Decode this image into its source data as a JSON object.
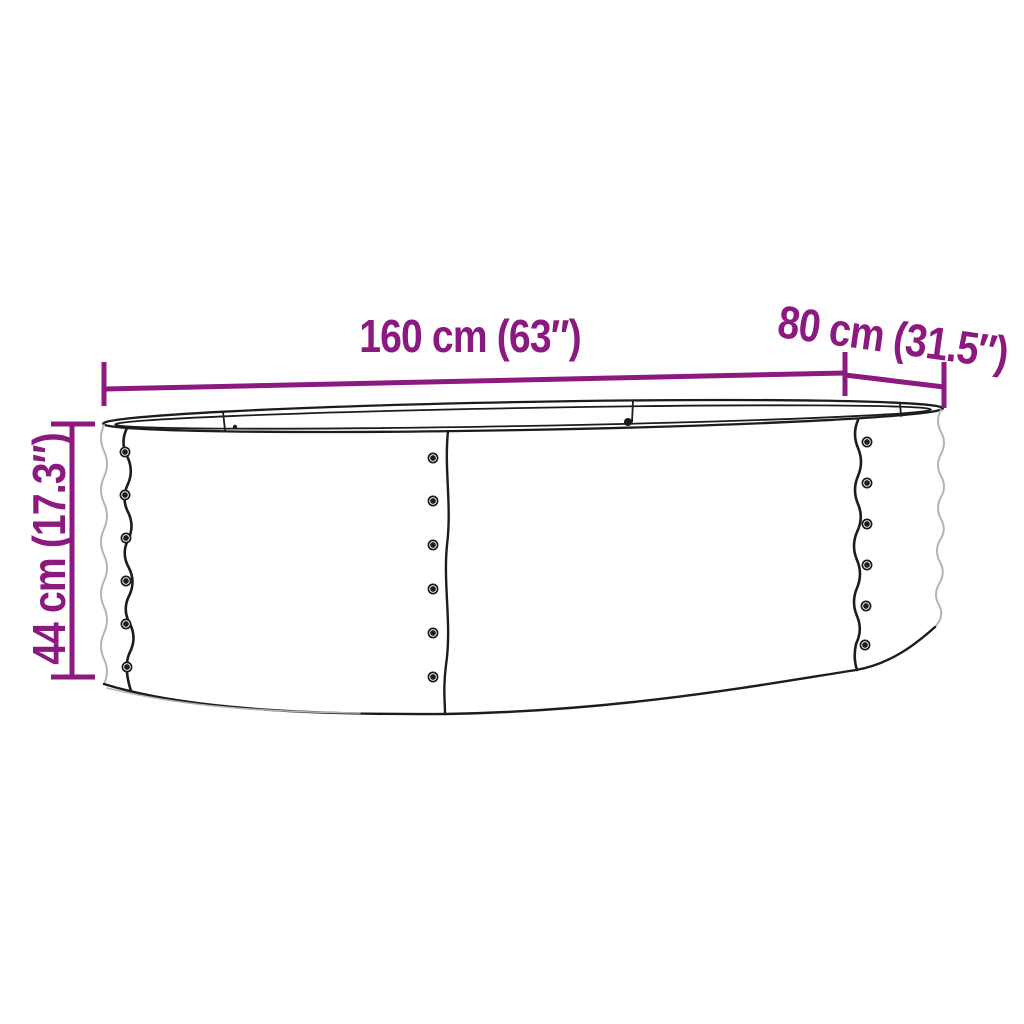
{
  "diagram": {
    "type": "product-dimension-diagram",
    "subject": "oval corrugated-metal raised bed planter, line drawing",
    "dimensions": {
      "length": {
        "label": "160 cm (63″)"
      },
      "depth": {
        "label": "80 cm (31.5″)"
      },
      "height": {
        "label": "44 cm (17.3″)"
      }
    },
    "colors": {
      "dimension_annotation": "#8b1980",
      "drawing_outline": "#1c1c1c",
      "drawing_light_line": "#b4b4b4",
      "background": "#ffffff"
    }
  }
}
